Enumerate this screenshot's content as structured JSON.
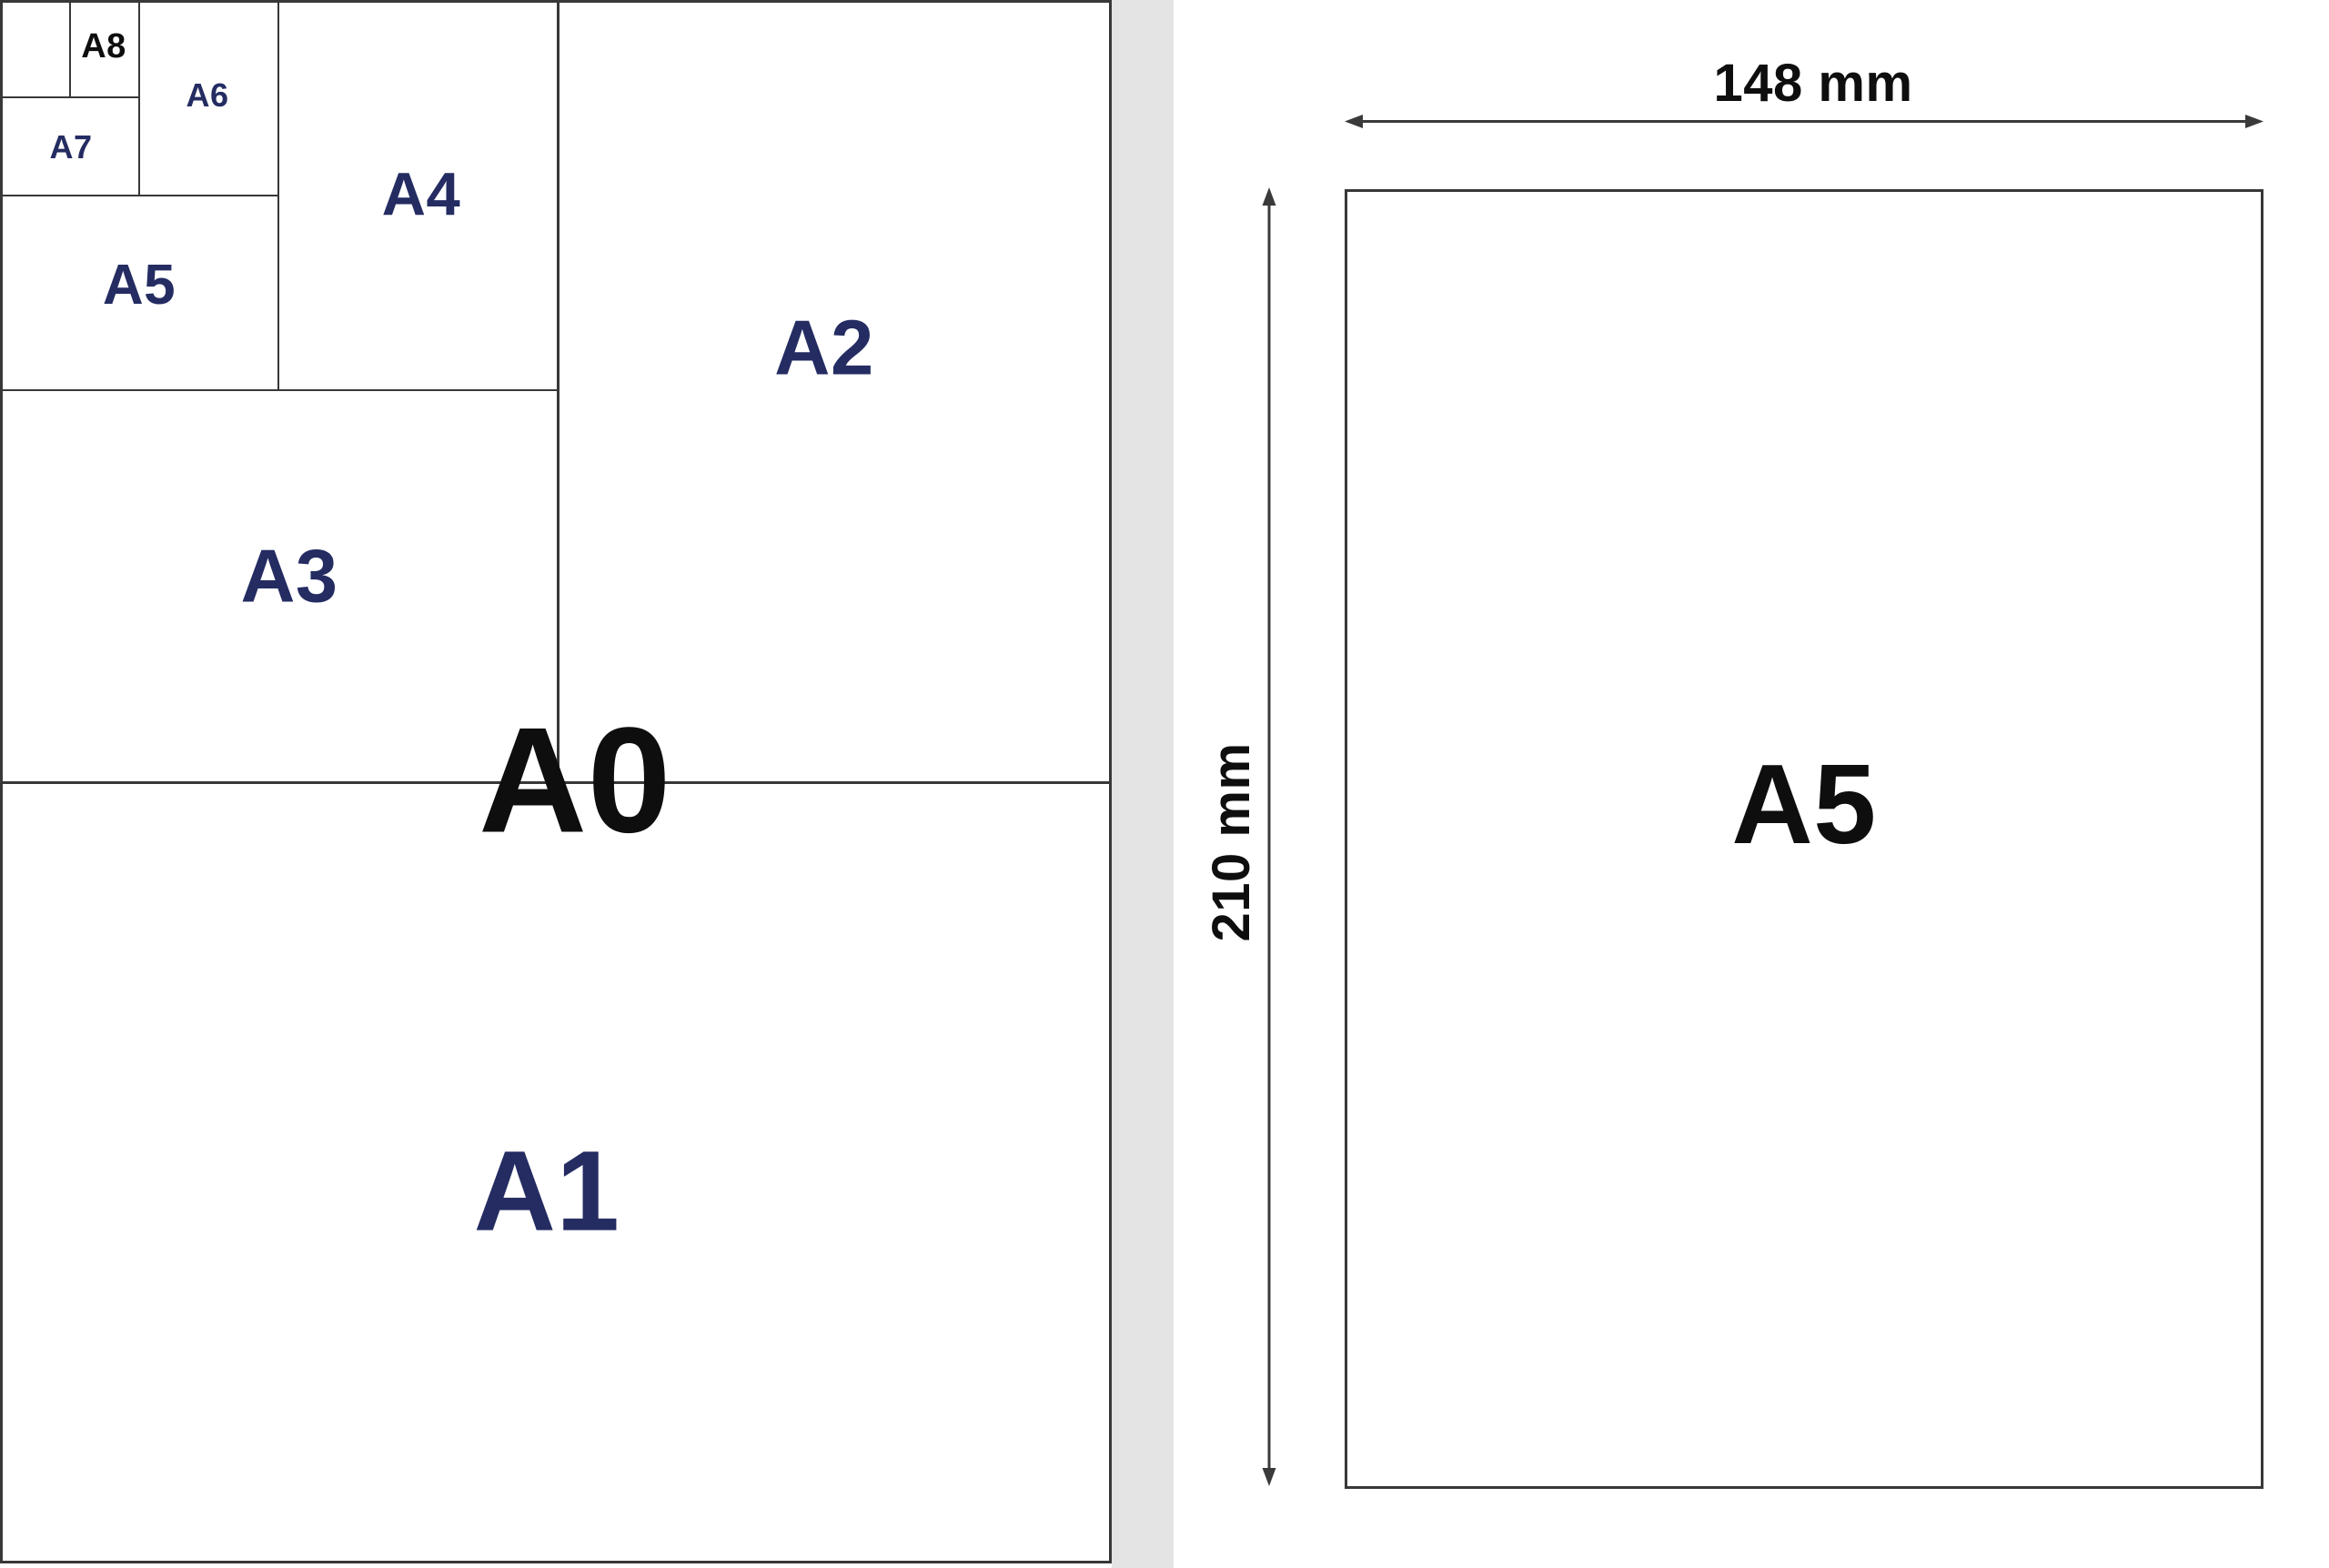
{
  "figure": {
    "a0_sheet": {
      "labels": {
        "a0": "A0",
        "a1": "A1",
        "a2": "A2",
        "a3": "A3",
        "a4": "A4",
        "a5": "A5",
        "a6": "A6",
        "a7": "A7",
        "a8": "A8"
      }
    },
    "a5_detail": {
      "page_label": "A5",
      "width_label": "148 mm",
      "height_label": "210 mm"
    },
    "colors": {
      "navy_label": "#242c62",
      "black_label": "#0e0e0e",
      "line": "#383838",
      "gutter_gray": "#e4e4e4",
      "background": "#ffffff"
    }
  }
}
